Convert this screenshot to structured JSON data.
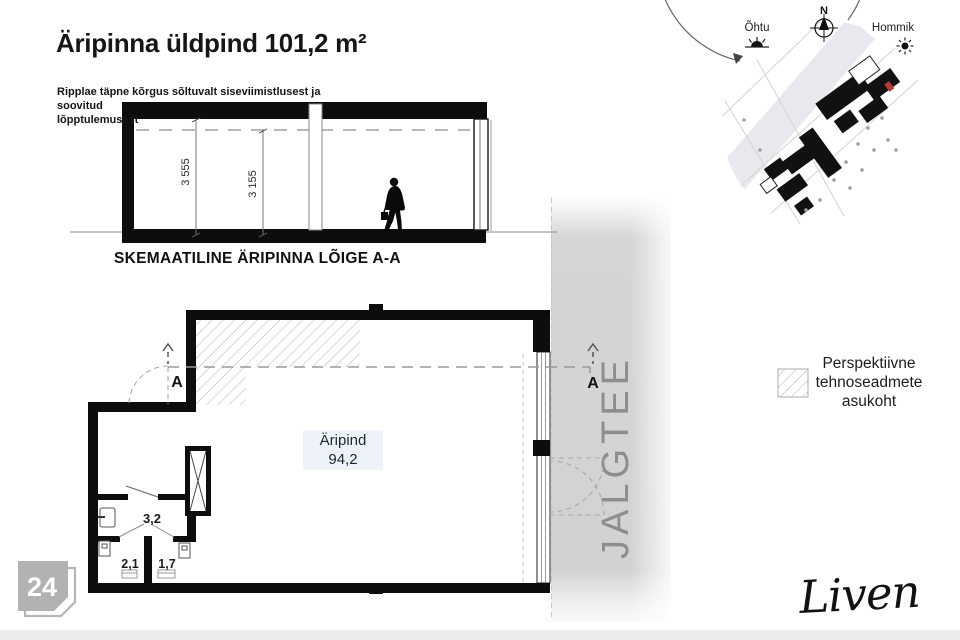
{
  "header": {
    "title": "Äripinna üldpind 101,2 m²",
    "note_line1": "Ripplae täpne kõrgus sõltuvalt siseviimistlusest ja soovitud",
    "note_line2": "lõpptulemusest"
  },
  "section_view": {
    "caption": "SKEMAATILINE ÄRIPINNA LÕIGE A-A",
    "dim_full_height": "3 555",
    "dim_ceiling_height": "3 155"
  },
  "floor_plan": {
    "main_room_name": "Äripind",
    "main_room_area": "94,2",
    "hall_area": "3,2",
    "wc_left_area": "2,1",
    "wc_right_area": "1,7",
    "section_marker": "A",
    "sidewalk_label": "JALGTEE"
  },
  "site_plan": {
    "north": "N",
    "west": "Õhtu",
    "east": "Hommik",
    "marker_color": "#b23a31"
  },
  "legend": {
    "line1": "Perspektiivne",
    "line2": "tehnoseadmete",
    "line3": "asukoht"
  },
  "footer": {
    "page_number": "24",
    "brand": "Liven"
  }
}
